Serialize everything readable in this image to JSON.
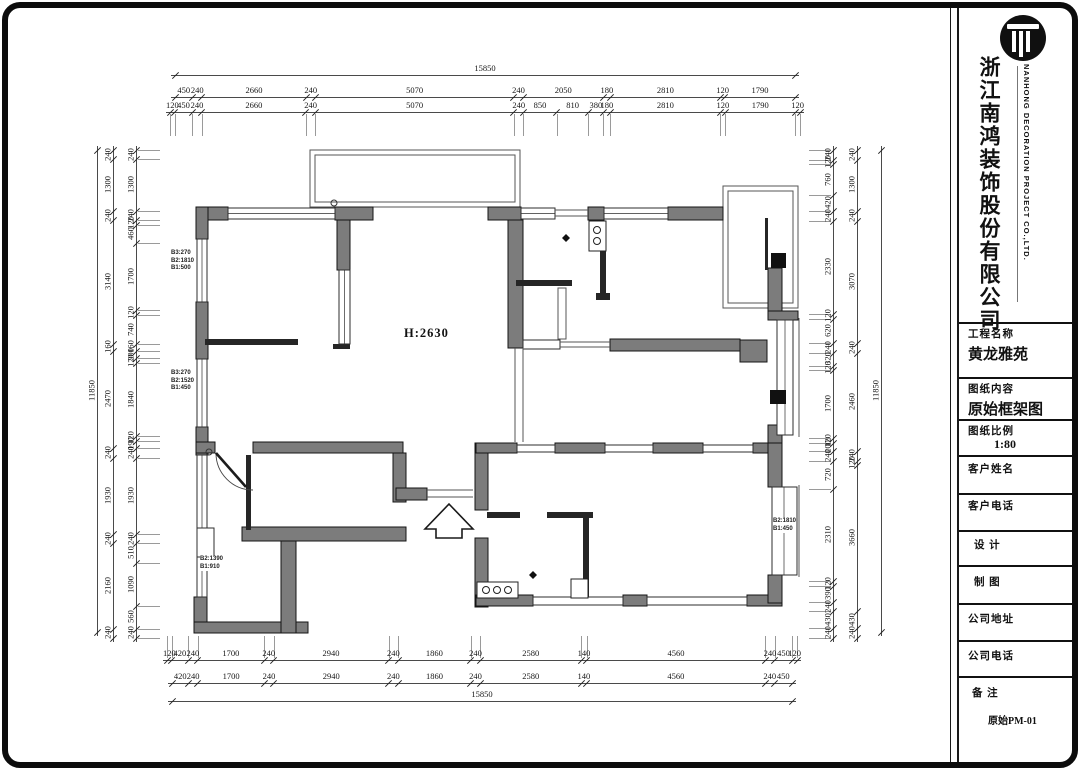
{
  "title_block": {
    "company_cn": "浙江南鸿装饰股份有限公司",
    "company_en": "NANHONG DECORATION PROJECT CO.,LTD.",
    "fields": [
      {
        "label": "工程名称",
        "value": "黄龙雅苑"
      },
      {
        "label": "图纸内容",
        "value": "原始框架图"
      },
      {
        "label": "图纸比例",
        "value": "1:80"
      },
      {
        "label": "客户姓名",
        "value": ""
      },
      {
        "label": "客户电话",
        "value": ""
      },
      {
        "label": "设  计",
        "value": ""
      },
      {
        "label": "制  图",
        "value": ""
      },
      {
        "label": "公司地址",
        "value": ""
      },
      {
        "label": "公司电话",
        "value": ""
      },
      {
        "label": "备  注",
        "value": "原始PM-01"
      }
    ]
  },
  "plan": {
    "ceiling_height": "H:2630",
    "window_annotations": [
      {
        "id": "win-left-upper",
        "lines": [
          "B3:270",
          "B2:1810",
          "B1:500"
        ]
      },
      {
        "id": "win-left-lower",
        "lines": [
          "B3:270",
          "B2:1520",
          "B1:450"
        ]
      },
      {
        "id": "win-bottom-left",
        "lines": [
          "B2:1390",
          "B1:910"
        ]
      },
      {
        "id": "win-right-lower",
        "lines": [
          "B2:1810",
          "B1:450"
        ]
      }
    ]
  },
  "dimensions": {
    "top_total": [
      15850
    ],
    "top_row2": [
      450,
      240,
      2660,
      240,
      5070,
      240,
      2050,
      180,
      2810,
      120,
      1790
    ],
    "top_row3": [
      120,
      450,
      240,
      2660,
      240,
      5070,
      240,
      850,
      810,
      380,
      180,
      2810,
      120,
      1790,
      120
    ],
    "bottom_row1": [
      120,
      420,
      240,
      1700,
      240,
      2940,
      240,
      1860,
      240,
      2580,
      140,
      4560,
      240,
      450,
      120
    ],
    "bottom_row2": [
      420,
      240,
      1700,
      240,
      2940,
      240,
      1860,
      240,
      2580,
      140,
      4560,
      240,
      450
    ],
    "bottom_total": [
      15850
    ],
    "left_total": [
      11850
    ],
    "left_outer": [
      240,
      1300,
      240,
      3140,
      160,
      2470,
      240,
      1930,
      240,
      2160,
      240
    ],
    "left_inner": [
      240,
      1300,
      240,
      120,
      460,
      1700,
      120,
      740,
      160,
      200,
      120,
      1840,
      120,
      190,
      240,
      1930,
      240,
      510,
      1090,
      560,
      240
    ],
    "right_total": [
      11850
    ],
    "right_mid": [
      240,
      1300,
      240,
      3070,
      240,
      2460,
      240,
      120,
      3660,
      430,
      240
    ],
    "right_inner": [
      240,
      120,
      760,
      420,
      240,
      2330,
      120,
      620,
      240,
      320,
      120,
      1700,
      120,
      200,
      240,
      720,
      2310,
      120,
      390,
      240,
      430,
      240
    ]
  }
}
